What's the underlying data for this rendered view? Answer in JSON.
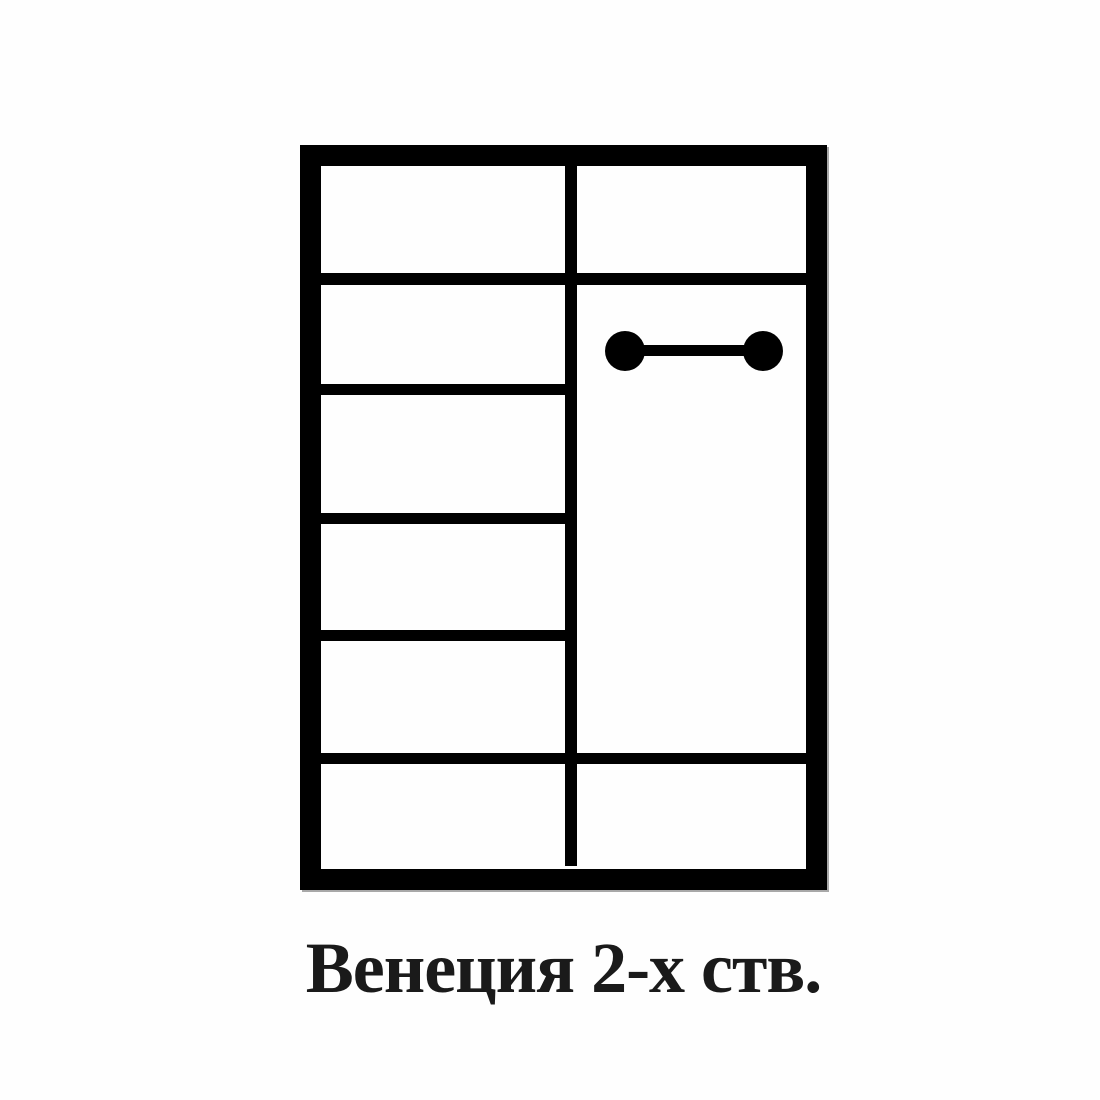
{
  "diagram": {
    "caption": "Венеция 2-х ств.",
    "colors": {
      "line_color": "#000000",
      "background_color": "#fefefe",
      "text_color": "#1a1a1a"
    },
    "wardrobe": {
      "columns": 2,
      "left_column_compartments": 6,
      "left_column_shelf_lines": 3,
      "full_width_shelf_lines": 2,
      "right_column_feature": "hanging-rod"
    }
  }
}
